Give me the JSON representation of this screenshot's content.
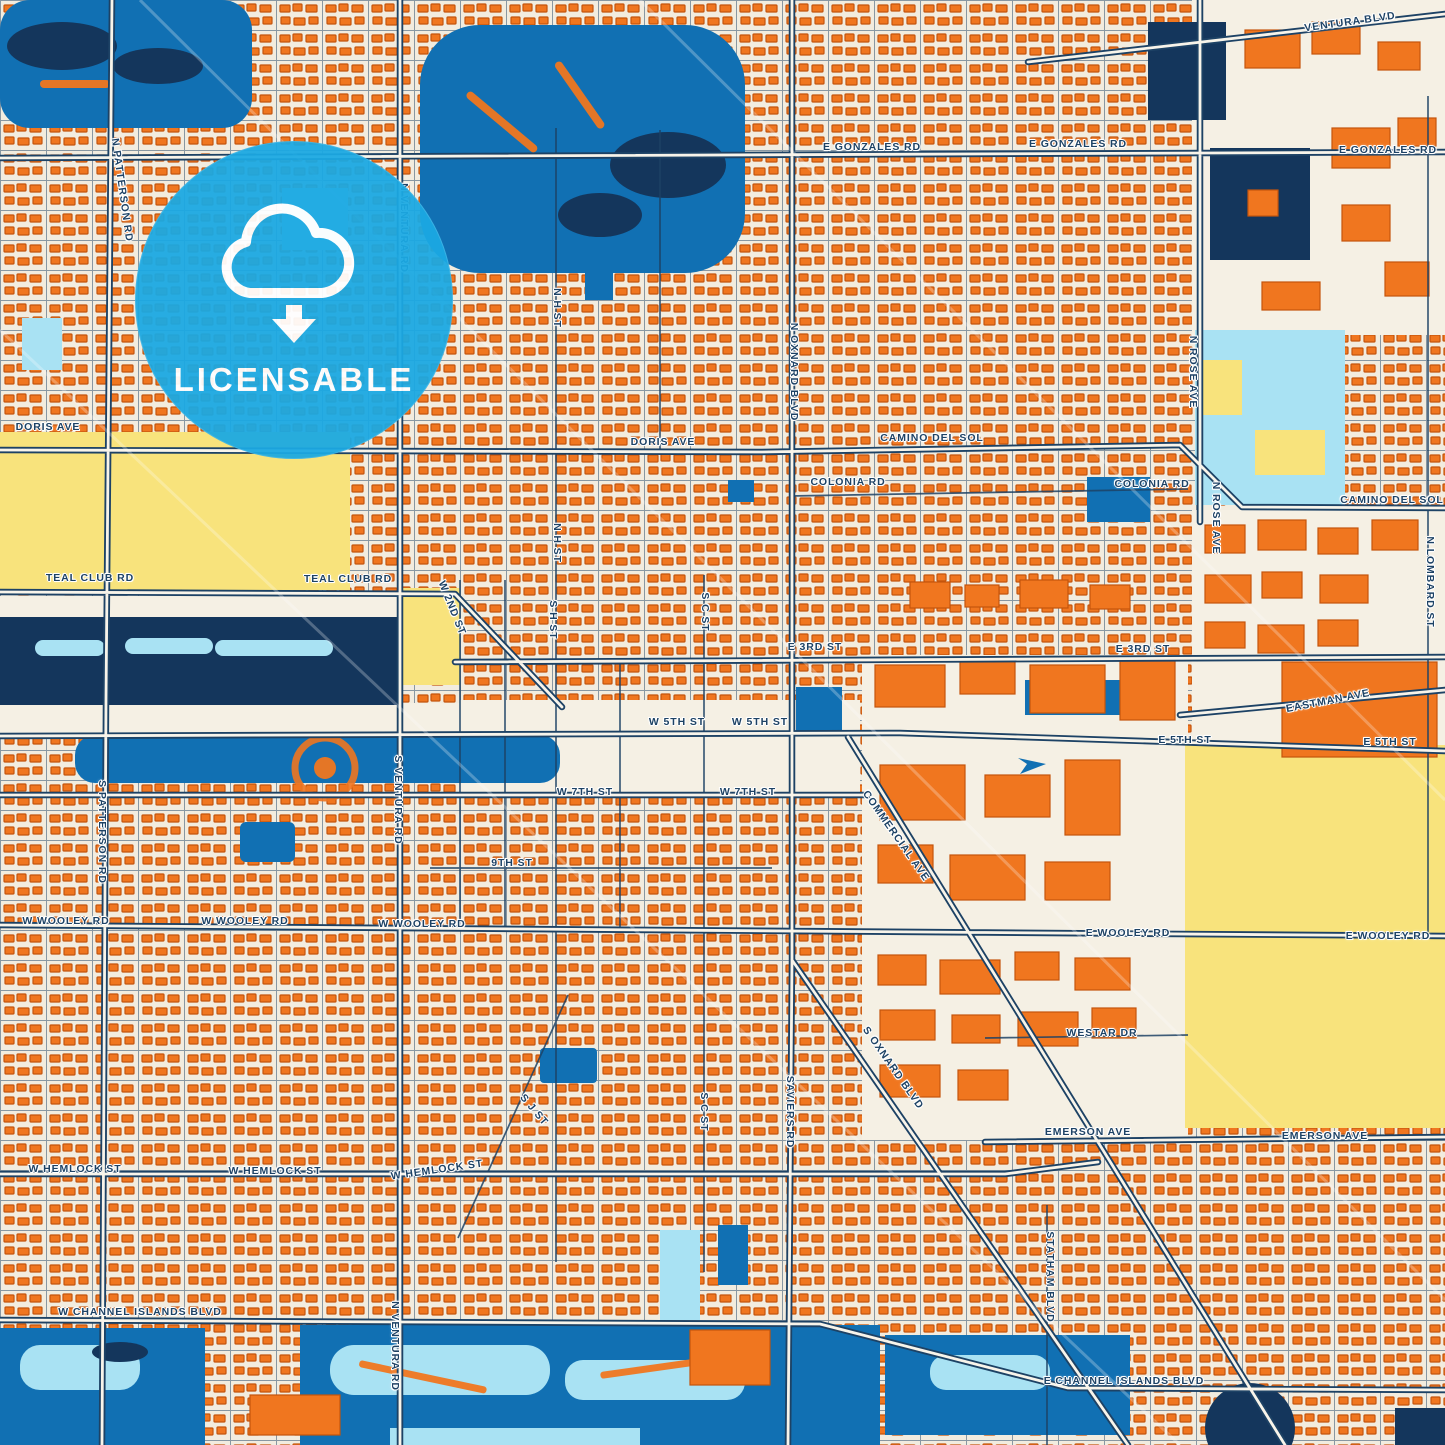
{
  "badge": {
    "label": "LICENSABLE",
    "icon": "cloud-download-icon"
  },
  "colors": {
    "cream": "#f2ecdf",
    "cream2": "#f5f0e4",
    "road_fill": "#f8f4ea",
    "orange": "#f0761f",
    "orange_dark": "#c4540c",
    "navy": "#1d4265",
    "water": "#1170b3",
    "water_deep": "#14365c",
    "cyan": "#a9e2f3",
    "yellow": "#f8e37c",
    "badge_blue": "#1ba9e3",
    "label": "#1d4265",
    "halo": "#ffffff"
  },
  "map": {
    "labels": [
      {
        "t": "N PATTERSON RD",
        "x": 122,
        "y": 190,
        "r": 82
      },
      {
        "t": "VENTURA BLVD",
        "x": 1350,
        "y": 22,
        "r": -8
      },
      {
        "t": "E GONZALES RD",
        "x": 872,
        "y": 147
      },
      {
        "t": "E GONZALES RD",
        "x": 1078,
        "y": 144
      },
      {
        "t": "E GONZALES RD",
        "x": 1388,
        "y": 150
      },
      {
        "t": "N VENTURA RD",
        "x": 404,
        "y": 228,
        "r": 90
      },
      {
        "t": "N H ST",
        "x": 557,
        "y": 308,
        "r": 90
      },
      {
        "t": "N OXNARD BLVD",
        "x": 794,
        "y": 372,
        "r": 90
      },
      {
        "t": "N ROSE AVE",
        "x": 1193,
        "y": 372,
        "r": 90
      },
      {
        "t": "N ROSE AVE",
        "x": 1216,
        "y": 518,
        "r": 90
      },
      {
        "t": "DORIS AVE",
        "x": 48,
        "y": 427
      },
      {
        "t": "DORIS AVE",
        "x": 663,
        "y": 442
      },
      {
        "t": "CAMINO DEL SOL",
        "x": 932,
        "y": 438
      },
      {
        "t": "CAMINO DEL SOL",
        "x": 1392,
        "y": 500
      },
      {
        "t": "COLONIA RD",
        "x": 848,
        "y": 482
      },
      {
        "t": "COLONIA RD",
        "x": 1152,
        "y": 484
      },
      {
        "t": "N H ST",
        "x": 557,
        "y": 543,
        "r": 90
      },
      {
        "t": "S H ST",
        "x": 553,
        "y": 620,
        "r": 90
      },
      {
        "t": "S C ST",
        "x": 705,
        "y": 612,
        "r": 90
      },
      {
        "t": "N LOMBARD ST",
        "x": 1430,
        "y": 582,
        "r": 90
      },
      {
        "t": "TEAL CLUB RD",
        "x": 90,
        "y": 578
      },
      {
        "t": "TEAL CLUB RD",
        "x": 348,
        "y": 579
      },
      {
        "t": "W 2ND ST",
        "x": 452,
        "y": 608,
        "r": 68
      },
      {
        "t": "E 3RD ST",
        "x": 815,
        "y": 647
      },
      {
        "t": "E 3RD ST",
        "x": 1143,
        "y": 649
      },
      {
        "t": "EASTMAN AVE",
        "x": 1328,
        "y": 701,
        "r": -11
      },
      {
        "t": "W 5TH ST",
        "x": 677,
        "y": 722
      },
      {
        "t": "W 5TH ST",
        "x": 760,
        "y": 722
      },
      {
        "t": "E 5TH ST",
        "x": 1185,
        "y": 740
      },
      {
        "t": "E 5TH ST",
        "x": 1390,
        "y": 742
      },
      {
        "t": "S PATTERSON RD",
        "x": 102,
        "y": 832,
        "r": 90
      },
      {
        "t": "S VENTURA RD",
        "x": 398,
        "y": 800,
        "r": 90
      },
      {
        "t": "W 7TH ST",
        "x": 585,
        "y": 792
      },
      {
        "t": "W 7TH ST",
        "x": 748,
        "y": 792
      },
      {
        "t": "COMMERCIAL AVE",
        "x": 896,
        "y": 836,
        "r": 55
      },
      {
        "t": "9TH ST",
        "x": 512,
        "y": 863
      },
      {
        "t": "W WOOLEY RD",
        "x": 66,
        "y": 921
      },
      {
        "t": "W WOOLEY RD",
        "x": 245,
        "y": 921
      },
      {
        "t": "W WOOLEY RD",
        "x": 422,
        "y": 924
      },
      {
        "t": "E WOOLEY RD",
        "x": 1128,
        "y": 933
      },
      {
        "t": "E WOOLEY RD",
        "x": 1388,
        "y": 936
      },
      {
        "t": "S OXNARD BLVD",
        "x": 893,
        "y": 1068,
        "r": 55
      },
      {
        "t": "WESTAR DR",
        "x": 1102,
        "y": 1033
      },
      {
        "t": "SAVIERS RD",
        "x": 790,
        "y": 1112,
        "r": 90
      },
      {
        "t": "S C ST",
        "x": 704,
        "y": 1112,
        "r": 90
      },
      {
        "t": "S J ST",
        "x": 534,
        "y": 1110,
        "r": 50
      },
      {
        "t": "EMERSON AVE",
        "x": 1088,
        "y": 1132
      },
      {
        "t": "EMERSON AVE",
        "x": 1325,
        "y": 1136
      },
      {
        "t": "W HEMLOCK ST",
        "x": 75,
        "y": 1169
      },
      {
        "t": "W HEMLOCK ST",
        "x": 275,
        "y": 1171
      },
      {
        "t": "W HEMLOCK ST",
        "x": 437,
        "y": 1170,
        "r": -8
      },
      {
        "t": "STATHAM BLVD",
        "x": 1050,
        "y": 1277,
        "r": 90
      },
      {
        "t": "W CHANNEL ISLANDS BLVD",
        "x": 140,
        "y": 1312
      },
      {
        "t": "N VENTURA RD",
        "x": 395,
        "y": 1346,
        "r": 90
      },
      {
        "t": "E CHANNEL ISLANDS BLVD",
        "x": 1124,
        "y": 1381
      }
    ]
  }
}
